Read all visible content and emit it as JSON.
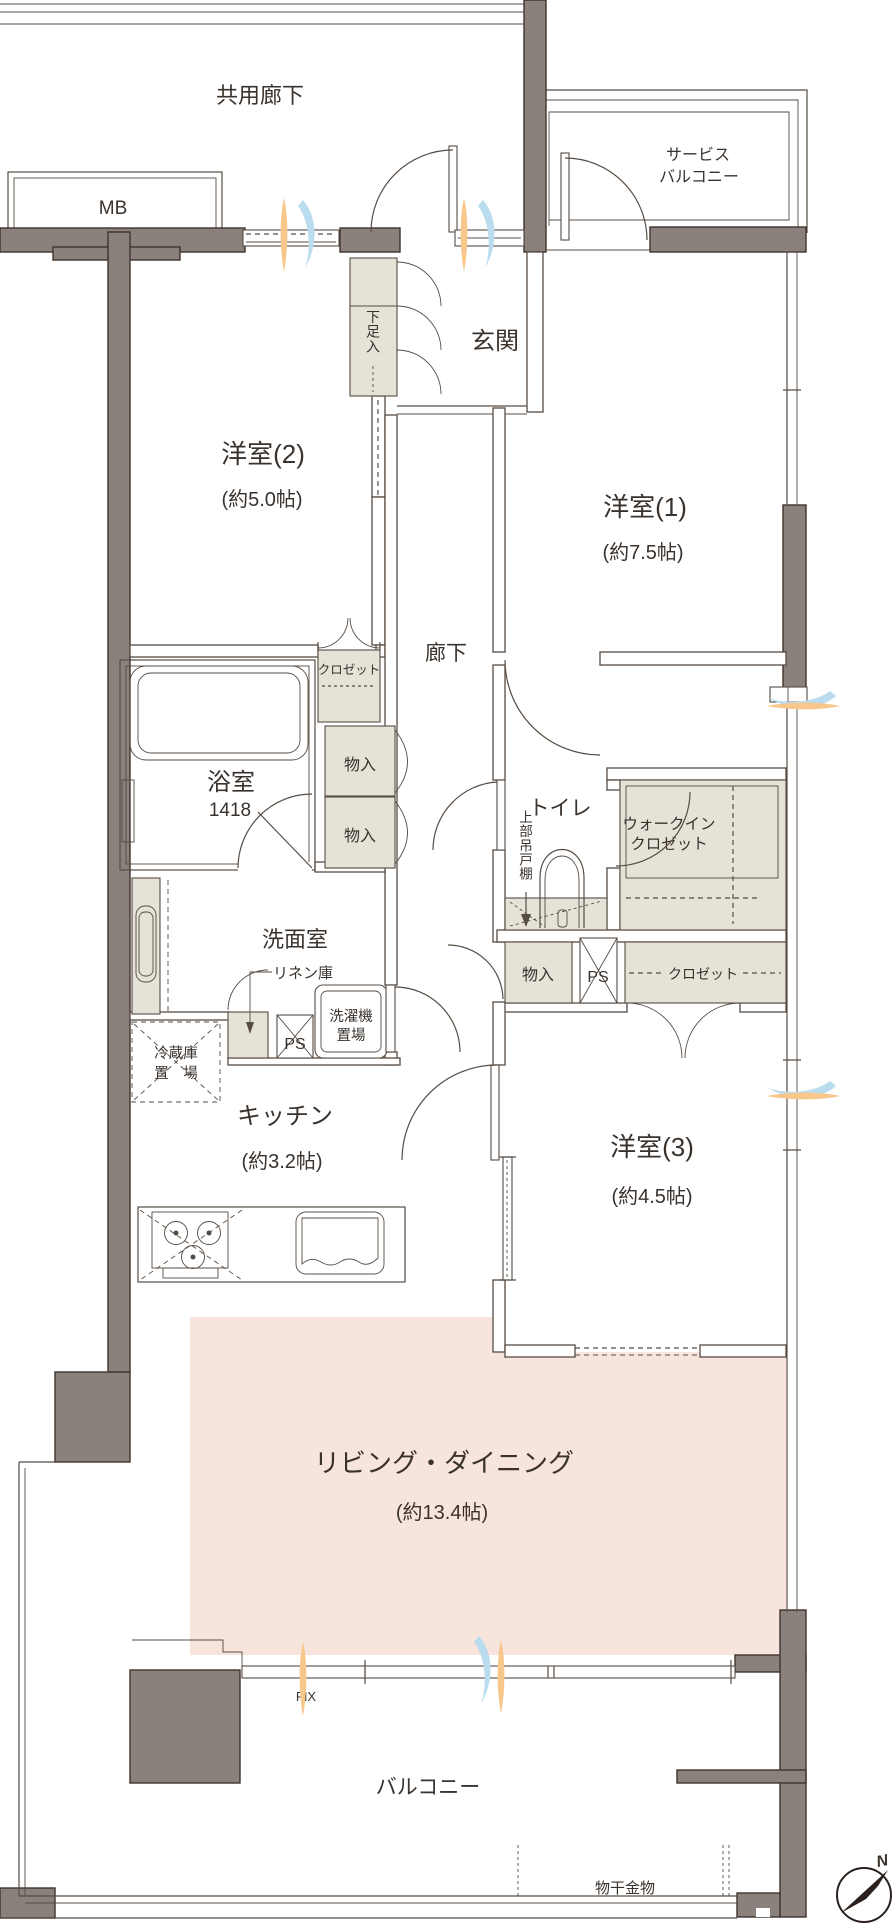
{
  "labels": {
    "common_corridor": "共用廊下",
    "mb": "MB",
    "service_balcony_1": "サービス",
    "service_balcony_2": "バルコニー",
    "genkan": "玄関",
    "shoe_cabinet": "下足入",
    "bedroom2_name": "洋室(2)",
    "bedroom2_size": "(約5.0帖)",
    "bedroom1_name": "洋室(1)",
    "bedroom1_size": "(約7.5帖)",
    "bedroom3_name": "洋室(3)",
    "bedroom3_size": "(約4.5帖)",
    "hallway": "廊下",
    "closet_bedroom2": "クロゼット",
    "bathroom_name": "浴室",
    "bathroom_size": "1418",
    "storage_a": "物入",
    "storage_b": "物入",
    "storage_c": "物入",
    "toilet": "トイレ",
    "upper_cabinet": "上部吊戸棚",
    "wic_1": "ウォークイン",
    "wic_2": "クロゼット",
    "washroom": "洗面室",
    "linen": "リネン庫",
    "ps_a": "PS",
    "ps_b": "PS",
    "washer_1": "洗濯機",
    "washer_2": "置場",
    "fridge_1": "冷蔵庫",
    "fridge_2": "置　場",
    "closet_bedroom3": "クロゼット",
    "kitchen_name": "キッチン",
    "kitchen_size": "(約3.2帖)",
    "living_name": "リビング・ダイニング",
    "living_size": "(約13.4帖)",
    "fix_window": "FIX",
    "balcony": "バルコニー",
    "laundry_hardware": "物干金物",
    "compass_north": "N"
  },
  "colors": {
    "wall": "#8a817d",
    "wall_stroke": "#40342d",
    "line": "#574c43",
    "storage_fill": "#e5e2d7",
    "living_fill": "#f7e4dc",
    "airflow_orange": "#f7c78c",
    "airflow_blue": "#b9dcee",
    "text": "#3a322c"
  }
}
